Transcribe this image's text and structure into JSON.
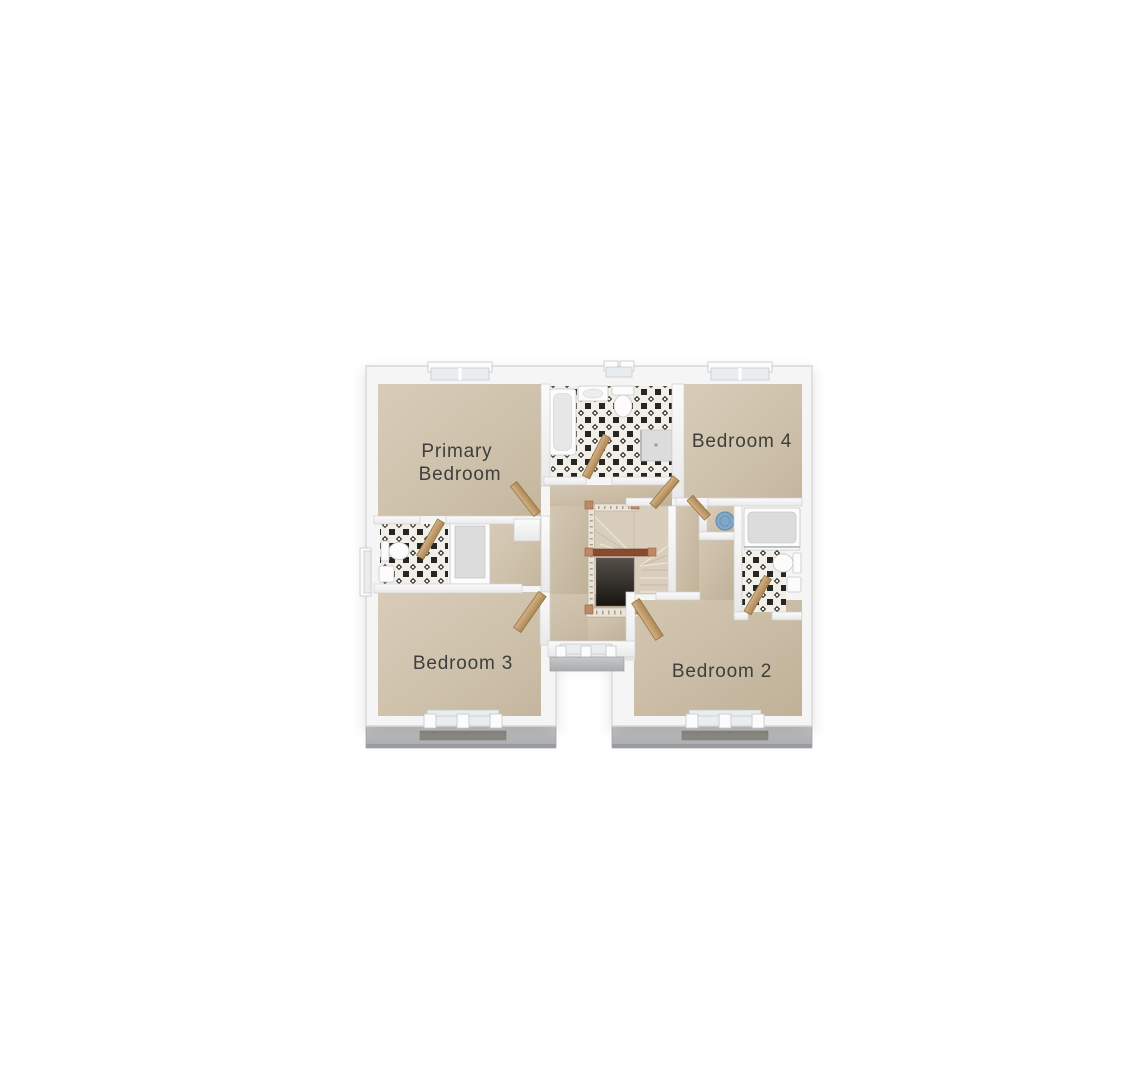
{
  "plan": {
    "type": "floor-plan",
    "rooms": [
      {
        "id": "primary-bedroom",
        "lines": [
          "Primary",
          "Bedroom"
        ]
      },
      {
        "id": "bedroom-4",
        "lines": [
          "Bedroom 4"
        ]
      },
      {
        "id": "bedroom-3",
        "lines": [
          "Bedroom 3"
        ]
      },
      {
        "id": "bedroom-2",
        "lines": [
          "Bedroom 2"
        ]
      }
    ],
    "unlabeled_features": [
      "family-bathroom",
      "en-suite-1",
      "en-suite-2",
      "landing",
      "winder-staircase",
      "airing-cupboard",
      "bathtub",
      "shower",
      "shower-bath",
      "toilets",
      "wash-basins",
      "blue-basin",
      "doors",
      "windows"
    ]
  },
  "colors": {
    "bg": "#ffffff",
    "label": "#3e3e3e",
    "wallEdge": "#cfcfcf",
    "fixture": "#fcfcfc",
    "fixtureEdge": "#c6c6c6",
    "tray": "#dcdcdc",
    "glass": "#e9edef",
    "woodEdge": "#97743f",
    "spindle": "#ebe4d7",
    "post": "#bd8968",
    "railDark": "#8a4a30",
    "tileDark": "#262624",
    "tileLight": "#f2efe9",
    "floorLight": "#d8ccb9",
    "floorDark": "#c4b69e",
    "sillLight": "#c6c8ca",
    "sillDark": "#acaeb0",
    "ledge": "#8d8a82",
    "basinBlue": "#7fa9c9"
  }
}
